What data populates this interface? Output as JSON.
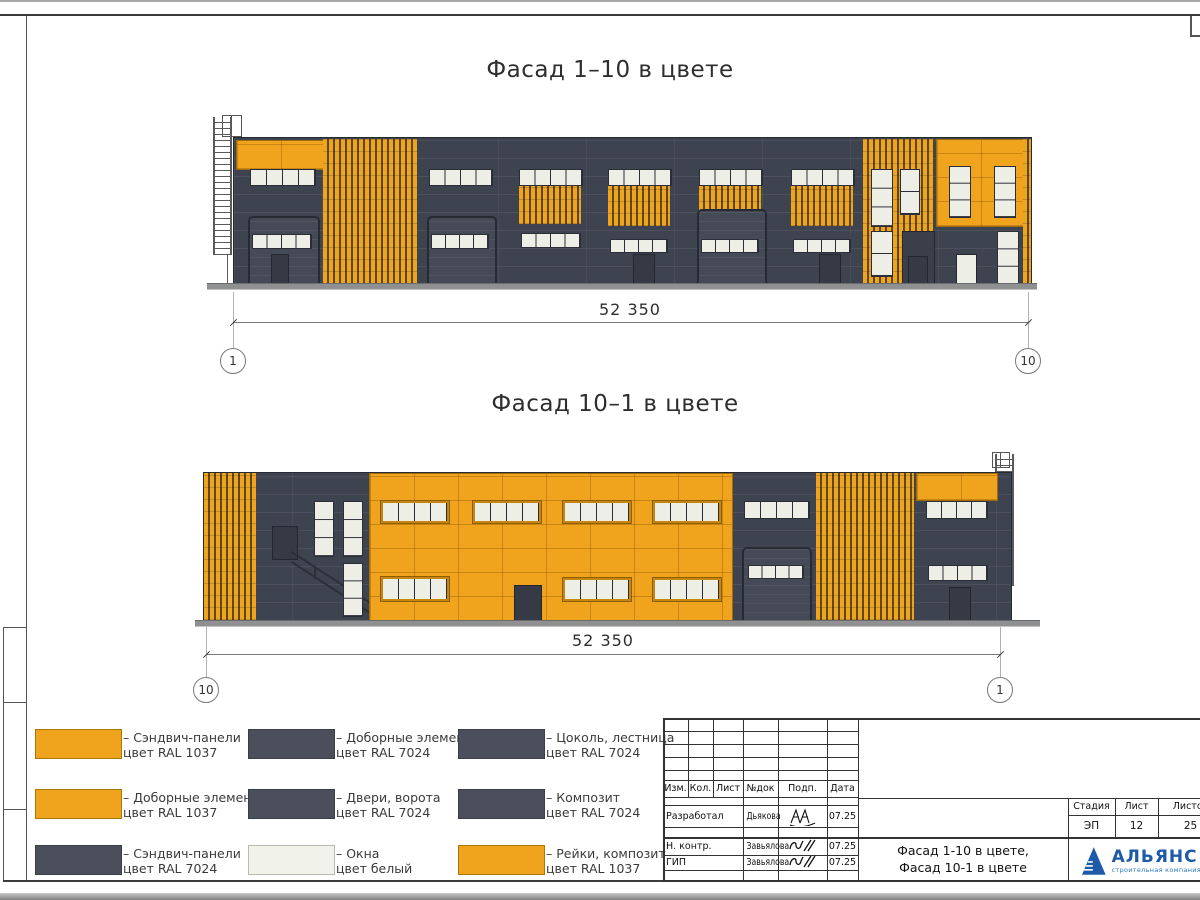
{
  "colors": {
    "orange": "#F0A41E",
    "dark": "#3E4350",
    "window": "#EDEFE6",
    "slat_gap": "#5A4A24",
    "legend_dark": "#4A4F5B",
    "logo_blue": "#1D5AA8",
    "logo_blue2": "#2F7BC4"
  },
  "facade1": {
    "title": "Фасад 1–10 в цвете",
    "dimension": "52 350",
    "axis_left": "1",
    "axis_right": "10"
  },
  "facade2": {
    "title": "Фасад 10–1 в цвете",
    "dimension": "52 350",
    "axis_left": "10",
    "axis_right": "1"
  },
  "legend": {
    "items": [
      {
        "color": "orange",
        "line1": "– Сэндвич-панели",
        "line2": "цвет RAL 1037"
      },
      {
        "color": "dark",
        "line1": "– Доборные элементы",
        "line2": "цвет RAL 7024"
      },
      {
        "color": "dark",
        "line1": "– Цоколь, лестница",
        "line2": "цвет RAL 7024"
      },
      {
        "color": "orange",
        "line1": "– Доборные элементы",
        "line2": "цвет RAL 1037"
      },
      {
        "color": "dark",
        "line1": "– Двери, ворота",
        "line2": "цвет RAL 7024"
      },
      {
        "color": "dark",
        "line1": "– Композит",
        "line2": "цвет RAL 7024"
      },
      {
        "color": "dark",
        "line1": "– Сэндвич-панели",
        "line2": "цвет RAL 7024"
      },
      {
        "color": "white",
        "line1": "– Окна",
        "line2": "цвет белый"
      },
      {
        "color": "orange",
        "line1": "– Рейки, композит",
        "line2": "цвет RAL 1037"
      }
    ]
  },
  "titleblock": {
    "columns": {
      "izm": "Изм.",
      "kol": "Кол.",
      "list": "Лист",
      "ndok": "№док",
      "podp": "Подп.",
      "data": "Дата"
    },
    "rows": [
      {
        "role": "Разработал",
        "name": "Дьякова",
        "date": "07.25"
      },
      {
        "role": "Н. контр.",
        "name": "Завьялова",
        "date": "07.25"
      },
      {
        "role": "ГИП",
        "name": "Завьялова",
        "date": "07.25"
      }
    ],
    "stage": {
      "stadia_label": "Стадия",
      "list_label": "Лист",
      "listov_label": "Листов",
      "stadia": "ЭП",
      "list": "12",
      "listov": "25"
    },
    "doc_line1": "Фасад 1-10 в цвете,",
    "doc_line2": "Фасад 10-1 в цвете",
    "logo": {
      "name": "АЛЬЯНС",
      "sub": "строительная компания"
    }
  }
}
